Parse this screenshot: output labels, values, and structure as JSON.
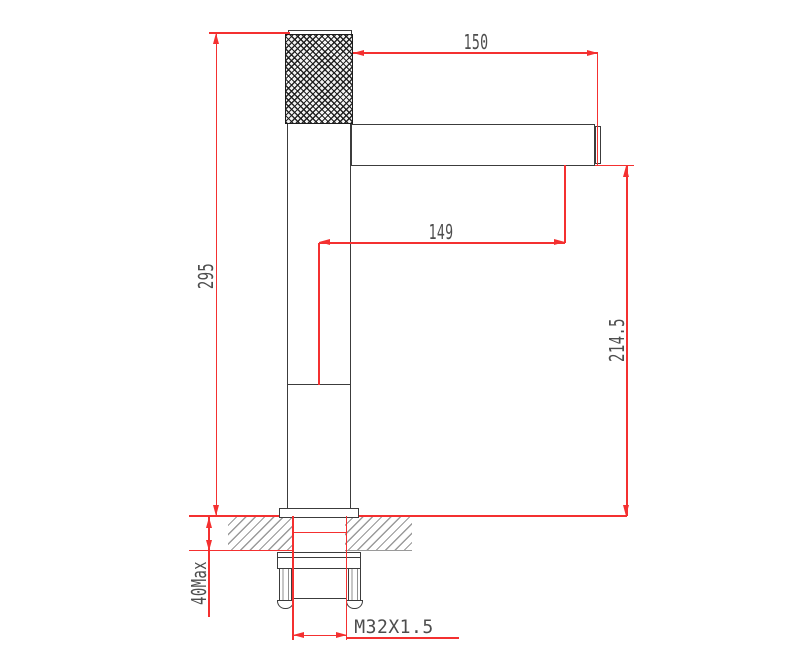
{
  "drawing": {
    "kind": "faucet installation dimension drawing",
    "labels": {
      "spout_length_top": "150",
      "spout_length_mid": "149",
      "overall_height": "295",
      "spout_outlet_height": "214.5",
      "deck_thickness_max": "40Max",
      "thread_spec": "M32X1.5"
    },
    "colors": {
      "dimension_red": "#f43030",
      "outline_ink": "#3c3c3c",
      "hatch_gray": "#9a9a9a",
      "label_gray": "#4d4d4d",
      "background": "#ffffff"
    }
  }
}
